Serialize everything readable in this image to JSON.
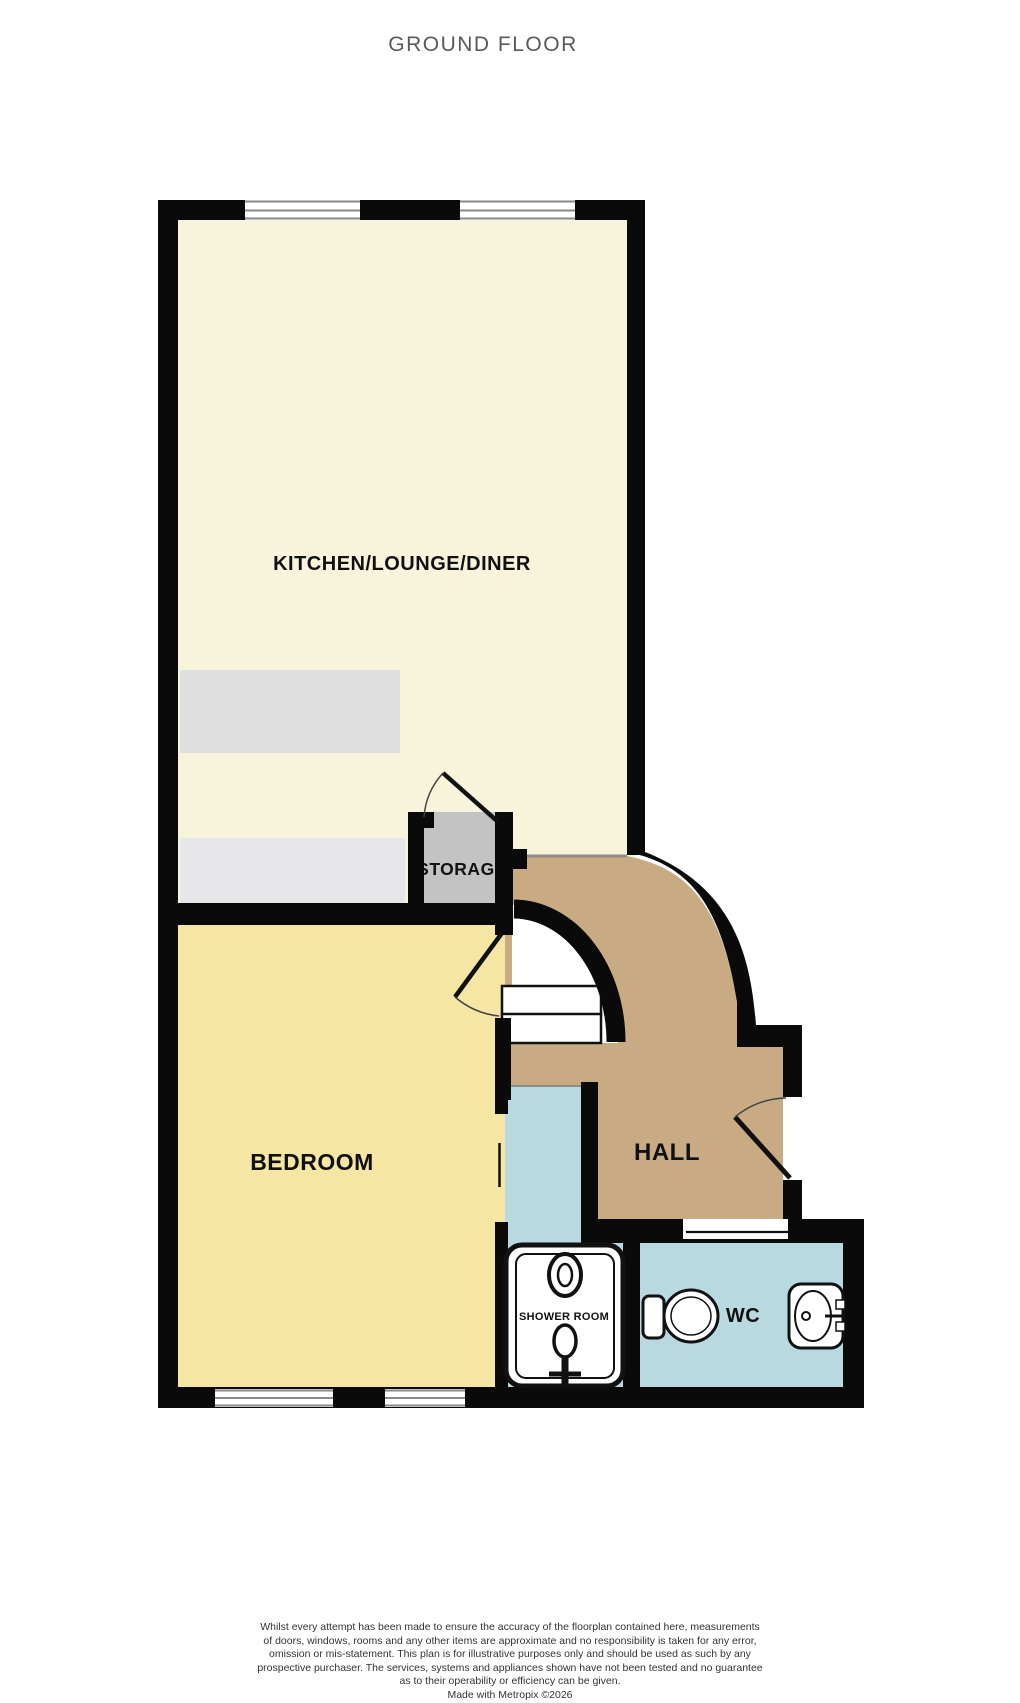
{
  "title": "GROUND FLOOR",
  "floorplan": {
    "wall_color": "#0a0a0a",
    "rooms": {
      "kitchen": {
        "label": "KITCHEN/LOUNGE/DINER",
        "color": "#f8f4dc"
      },
      "bedroom": {
        "label": "BEDROOM",
        "color": "#f6e6a4"
      },
      "hall": {
        "label": "HALL",
        "color": "#c9ab83"
      },
      "storage": {
        "label": "STORAGE",
        "color": "#c3c3c3"
      },
      "shower_room": {
        "label": "SHOWER ROOM",
        "color": "#b9d9e1"
      },
      "wc": {
        "label": "WC",
        "color": "#b9d9e1"
      }
    }
  },
  "disclaimer": {
    "lines": [
      "Whilst every attempt has been made to ensure the accuracy of the floorplan contained here, measurements",
      "of doors, windows, rooms and any other items are approximate and no responsibility is taken for any error,",
      "omission or mis-statement. This plan is for illustrative purposes only and should be used as such by any",
      "prospective purchaser. The services, systems and appliances shown have not been tested and no guarantee",
      "as to their operability or efficiency can be given."
    ],
    "credit": "Made with Metropix ©2026"
  }
}
